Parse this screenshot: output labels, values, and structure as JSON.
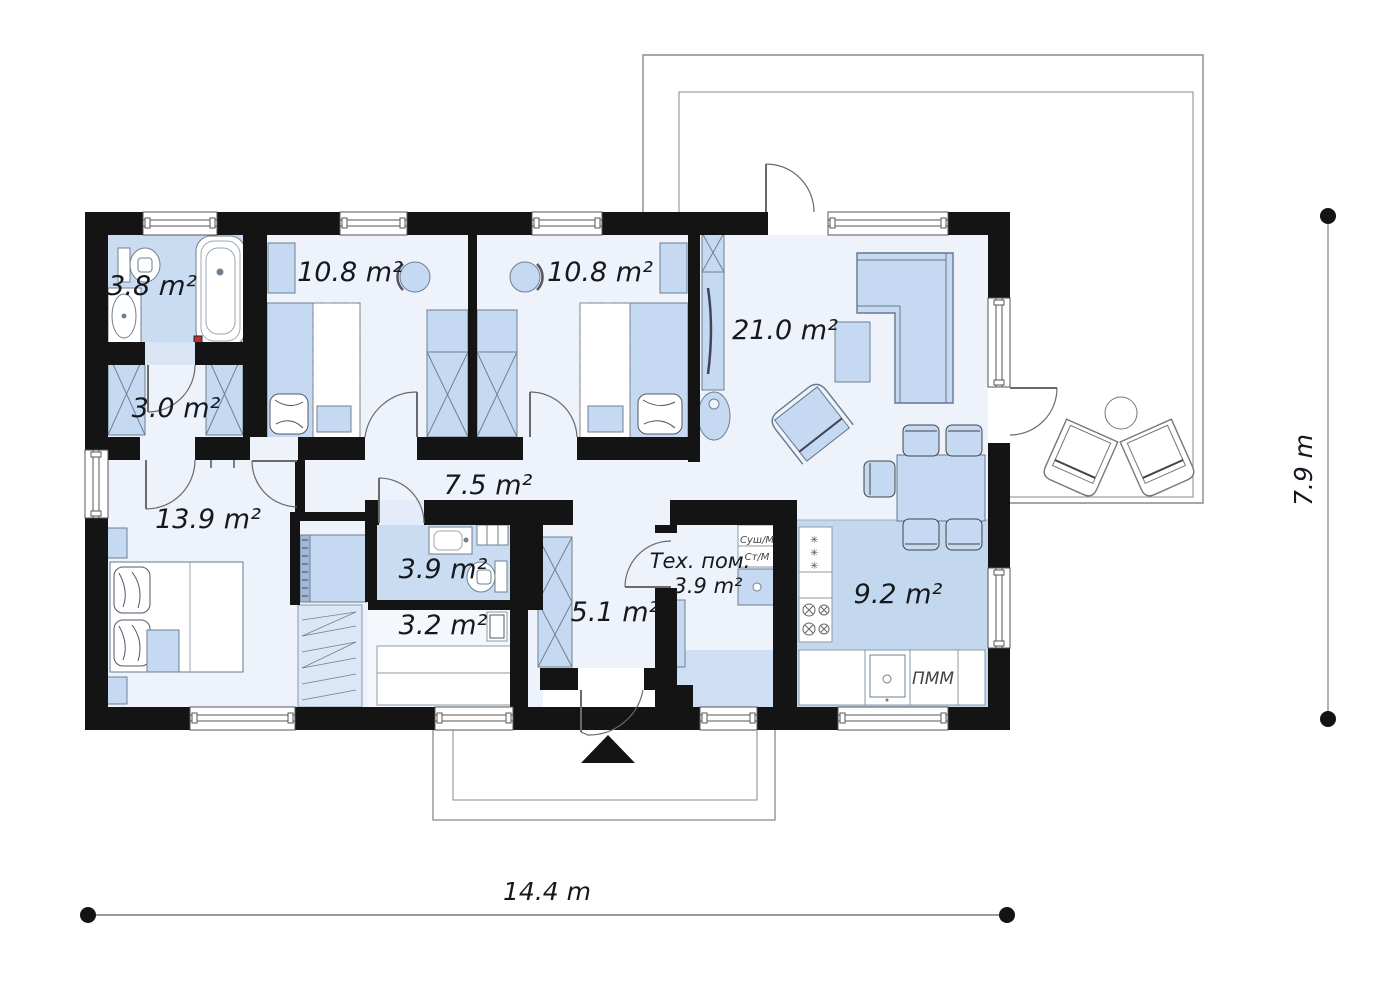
{
  "rooms": [
    {
      "id": "bathroom-1",
      "label": "3.8 m²"
    },
    {
      "id": "wardrobe-hall",
      "label": "3.0 m²"
    },
    {
      "id": "bedroom-1",
      "label": "10.8 m²"
    },
    {
      "id": "bedroom-2",
      "label": "10.8 m²"
    },
    {
      "id": "living-room",
      "label": "21.0 m²"
    },
    {
      "id": "corridor",
      "label": "7.5 m²"
    },
    {
      "id": "master-bedroom",
      "label": "13.9 m²"
    },
    {
      "id": "bathroom-2",
      "label": "3.9 m²"
    },
    {
      "id": "storage",
      "label": "3.2 m²"
    },
    {
      "id": "entry-hall",
      "label": "5.1 m²"
    },
    {
      "id": "tech-room",
      "name": "Тех. пом.",
      "label": "3.9 m²"
    },
    {
      "id": "kitchen",
      "label": "9.2 m²"
    }
  ],
  "appliances": {
    "dishwasher": "ПММ",
    "dryer": "Суш/М",
    "washer": "Ст/М",
    "freezer_icon": "✳"
  },
  "dimensions": {
    "width": "14.4 m",
    "depth": "7.9 m"
  },
  "colors": {
    "wall": "#141414",
    "floor": "#edf2fb",
    "wet_floor": "#c9dcf2",
    "kitchen_floor": "#c3d7ef",
    "furniture": "#c5d9f2",
    "furniture_outline": "#66788f",
    "thin_line": "#8a8a8a"
  }
}
